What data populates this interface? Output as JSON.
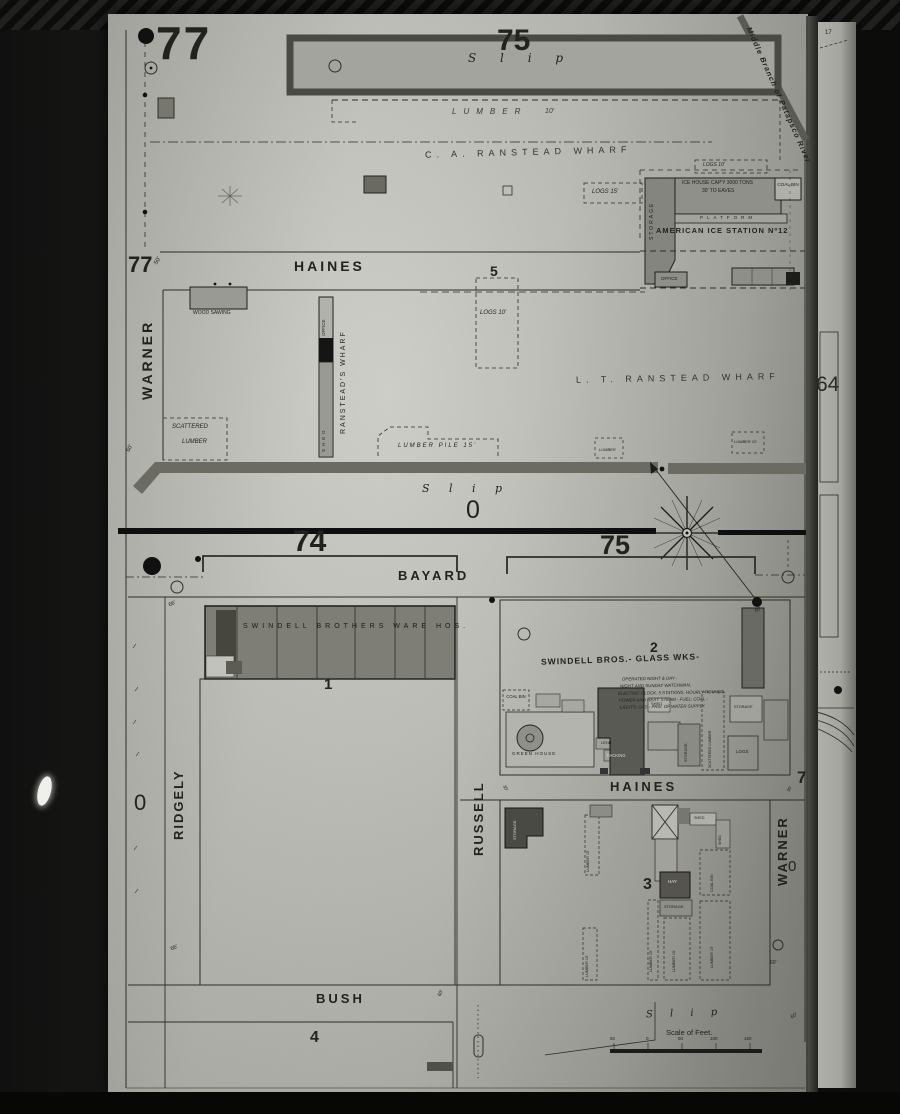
{
  "blocks": {
    "b77_top": "77",
    "b77_mid": "77",
    "b75_slip": "75",
    "b5": "5",
    "b74": "74",
    "b75": "75",
    "b1": "1",
    "b2": "2",
    "b3": "3",
    "b4": "4",
    "b64": "64",
    "b7_edge": "7",
    "b0_edge": "0",
    "b0_left": "0",
    "wharf_zero": "0",
    "edge17": "17"
  },
  "streets": {
    "warner_upper": "WARNER",
    "haines_upper": "HAINES",
    "bayard": "BAYARD",
    "ridgely": "RIDGELY",
    "russell": "RUSSELL",
    "haines_lower": "HAINES",
    "warner_lower": "WARNER",
    "bush": "BUSH"
  },
  "water": {
    "slip_top": "S l i p",
    "slip_mid": "S l i p",
    "slip_bottom": "S l i p",
    "river": "Middle Branch of Patapsco River"
  },
  "wharves": {
    "ca_ranstead": "C. A. RANSTEAD WHARF",
    "lt_ranstead": "L. T. RANSTEAD WHARF",
    "ranstead_vert": "RANSTEAD'S WHARF"
  },
  "ice_station": {
    "name": "AMERICAN ICE STATION Nº12",
    "ice_house": "ICE HOUSE CAP'Y 3000 TONS",
    "eaves": "30' TO EAVES",
    "coal_bin": "COAL BIN",
    "platform": "PLATFORM",
    "storage": "STORAGE",
    "office": "OFFICE",
    "logs": "LOGS 10'"
  },
  "warehouse": {
    "label": "SWINDELL BROTHERS WARE HOS."
  },
  "glassworks": {
    "name": "SWINDELL BROS.- GLASS WKS-",
    "notes": [
      "OPERATED NIGHT & DAY -",
      "NIGHT AND SUNDAY WATCHMAN,",
      "ELECTRIC CLOCK, 5 STATIONS, HOURLY ROUNDS,",
      "POWER AND HEAT: STEAM - FUEL: COAL -",
      "LIGHTS: GAS - PRIV. OF WATER SUPPLY."
    ],
    "coal_bin": "COAL BIN",
    "green_house": "GREEN HOUSE",
    "lehr": "LEHR",
    "packing": "PACKING",
    "shed": "SHED",
    "storage_a": "STORAGE",
    "storage_b": "STORAGE",
    "scattered_lumber": "SCATTERED LUMBER",
    "logs": "LOGS"
  },
  "block3": {
    "storage_a": "STORAGE",
    "storage_b": "STORAGE",
    "shed_a": "SHED",
    "shed_b": "SHED",
    "coal_bin": "COAL BIN",
    "hay": "HAY",
    "lumber_a": "LUMBER 15'",
    "lumber_b": "LUMBER 15'",
    "lumber_c": "LUMBER 15'",
    "lumber_d": "LUMBER 15'",
    "lumber_e": "LUMBER 15'"
  },
  "yards": {
    "lumber_top": "LUMBER",
    "lumber_top_dim": "10'",
    "logs15": "LOGS 15'",
    "logs10": "LOGS 10'",
    "scattered_l1": "SCATTERED",
    "scattered_l2": "LUMBER",
    "lumber_pile": "LUMBER PILE 15'",
    "lumber_small": "LUMBER",
    "lumber_small2": "LUMBER 10'",
    "wood_sawing": "WOOD SAWING",
    "office": "OFFICE",
    "shed": "SHED"
  },
  "dims": {
    "d50": "50'",
    "d60a": "60'",
    "d60b": "60'",
    "d60c": "60'",
    "d60d": "60'",
    "d60e": "60'",
    "d66a": "66'",
    "d66b": "66'",
    "d30a": "30'",
    "d30b": "30'"
  },
  "scale": {
    "label": "Scale of Feet.",
    "ticks": [
      "50",
      "0",
      "50",
      "100",
      "150"
    ]
  }
}
